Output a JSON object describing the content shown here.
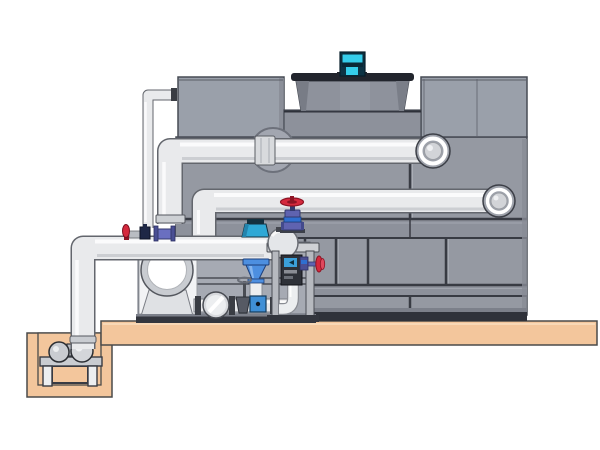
{
  "scene": {
    "kind": "3d-cad-illustration",
    "subject": "cooling-tower-with-pump-skid-and-sump-piping",
    "visible_text": []
  },
  "palette": {
    "background": "#ffffff",
    "tower_gray": "#9599a2",
    "tower_top_gray": "#9aa0aa",
    "tower_line": "#383b43",
    "tower_band": "#8d919b",
    "tower_base_dark": "#2f323a",
    "fan_cowl_gray": "#8e929c",
    "fan_rim_dark": "#22252d",
    "motor_cyan": "#35cdea",
    "motor_dark": "#0d3344",
    "pipe_light": "#e9eaec",
    "pipe_edge": "#63666d",
    "platform_tan": "#f3c69c",
    "outline_dark": "#4a4a4a",
    "valve_red": "#d5293d",
    "valve_red_dark": "#8e1424",
    "valve_purple": "#5f63b0",
    "valve_purple_dark": "#343a6e",
    "valve_navy": "#1e2746",
    "sensor_blue": "#2fa8d5",
    "strainer_blue": "#4d8fe0",
    "screen_blue": "#3b9fd9",
    "steel_light": "#eceef0",
    "steel_mid": "#c9ccd1",
    "steel_dark": "#3a3d44",
    "skid_dark": "#33363e",
    "white_panel": "#f2f3f5"
  }
}
